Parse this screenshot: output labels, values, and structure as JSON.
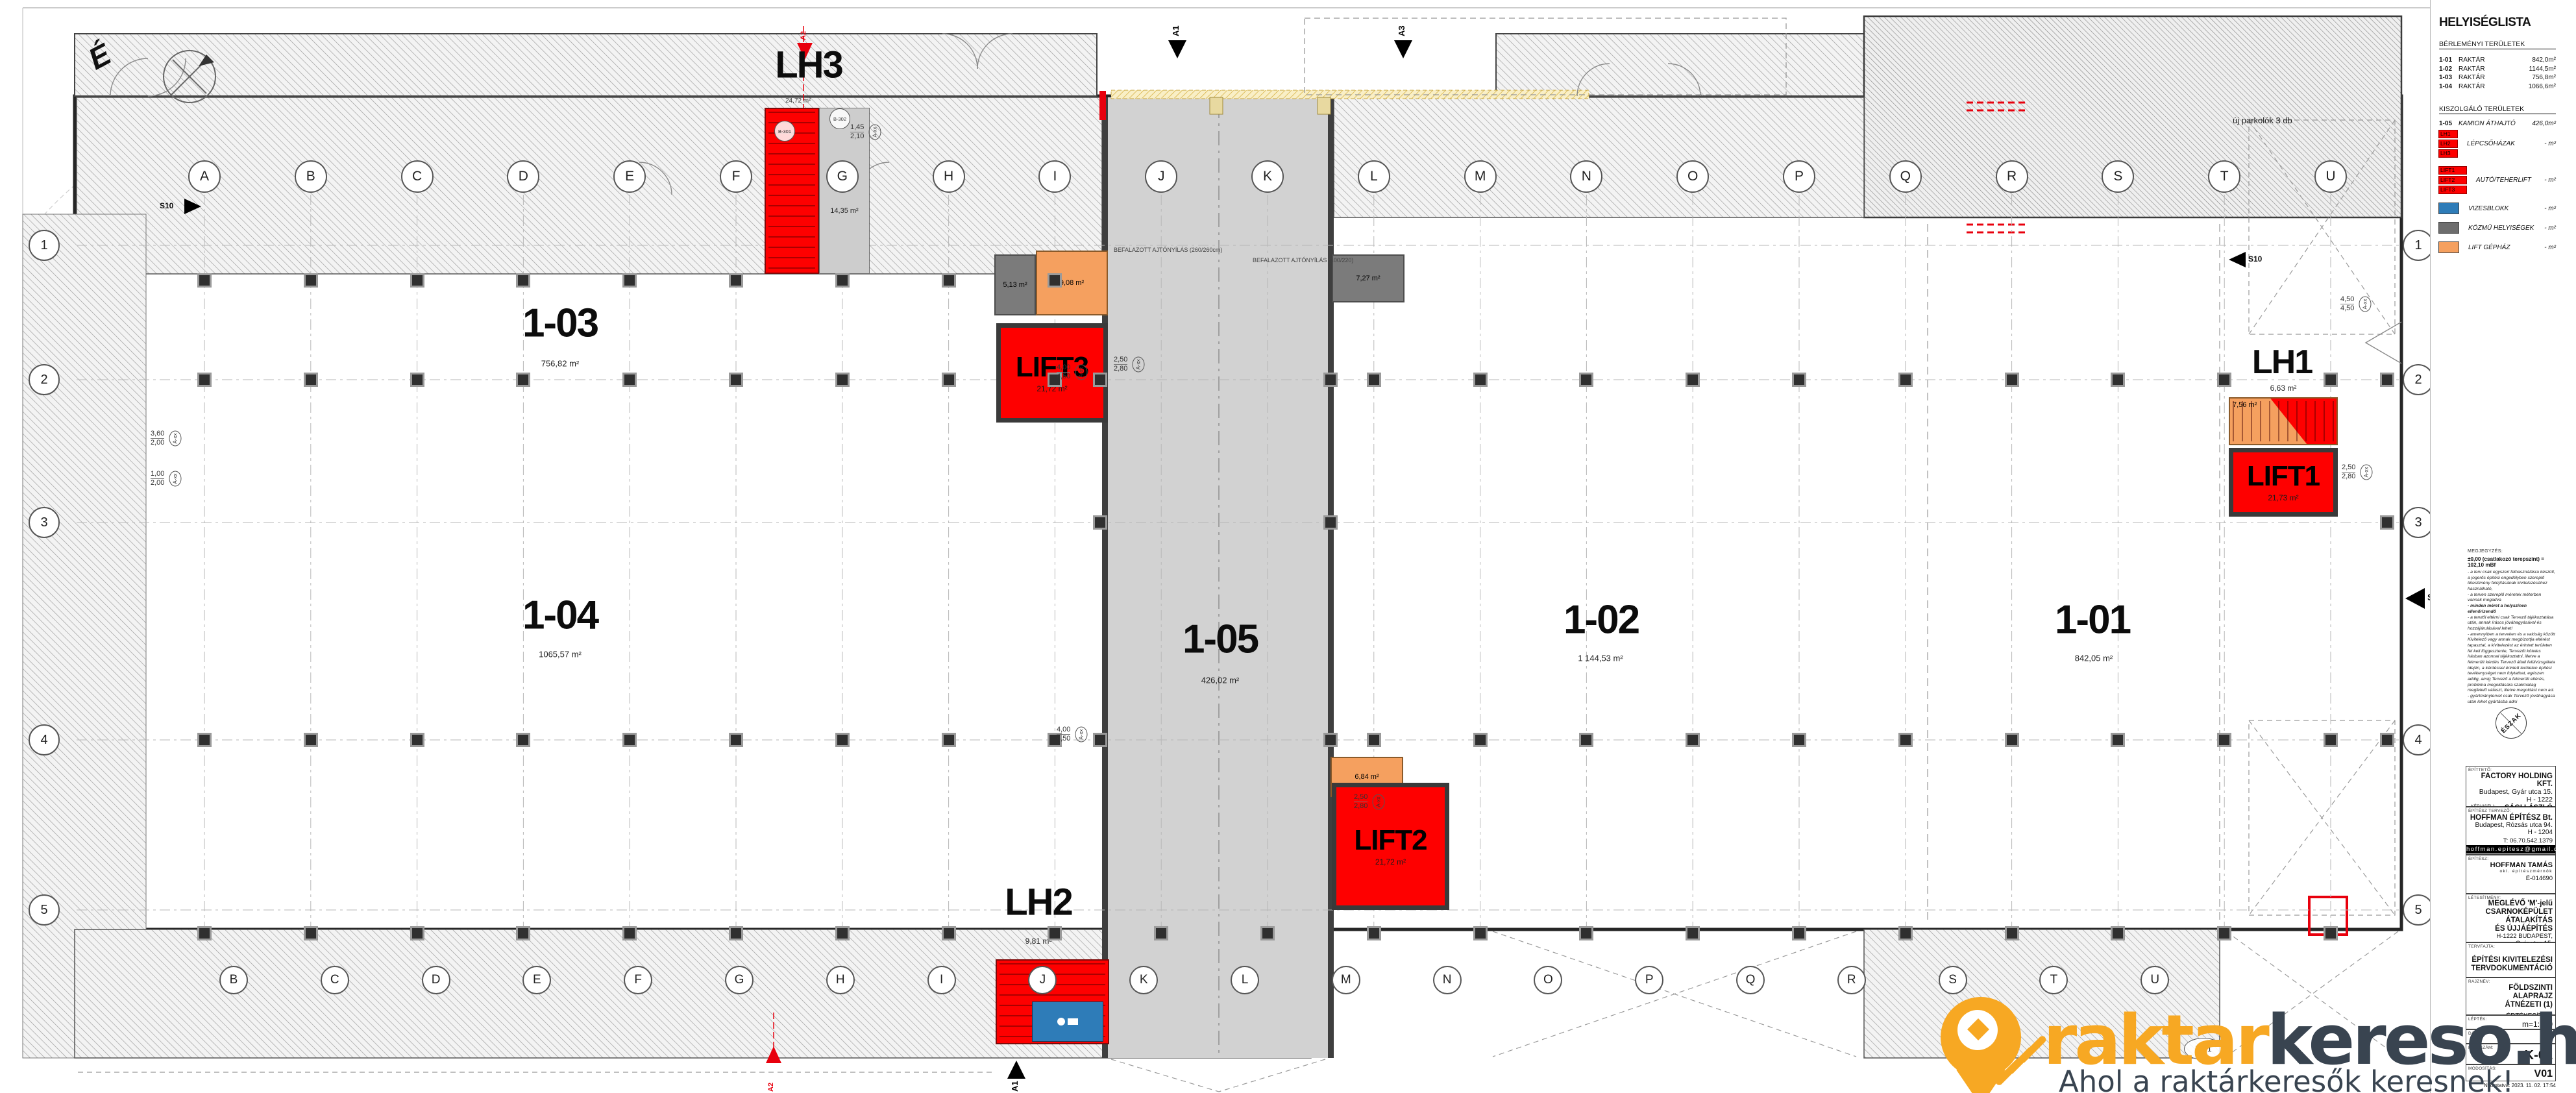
{
  "legend": {
    "title": "HELYISÉGLISTA",
    "rental_heading": "BÉRLEMÉNYI TERÜLETEK",
    "rental_rows": [
      {
        "id": "1-01",
        "name": "RAKTÁR",
        "area": "842,0m²"
      },
      {
        "id": "1-02",
        "name": "RAKTÁR",
        "area": "1144,5m²"
      },
      {
        "id": "1-03",
        "name": "RAKTÁR",
        "area": "756,8m²"
      },
      {
        "id": "1-04",
        "name": "RAKTÁR",
        "area": "1066,6m²"
      }
    ],
    "service_heading": "KISZOLGÁLÓ TERÜLETEK",
    "service_rows": [
      {
        "id": "1-05",
        "name": "KAMION ÁTHAJTÓ",
        "area": "426,0m²"
      }
    ],
    "tag_rows": [
      {
        "tags": [
          "LH1",
          "LH2",
          "LH3"
        ],
        "label": "LÉPCSŐHÁZAK",
        "area": "- m²"
      },
      {
        "tags": [
          "LIFT1",
          "LIFT2",
          "LIFT3"
        ],
        "label": "AUTÓ/TEHERLIFT",
        "area": "- m²"
      }
    ],
    "swatch_rows": [
      {
        "color": "#2e7cb8",
        "label": "VIZESBLOKK",
        "area": "- m²"
      },
      {
        "color": "#6d6d6d",
        "label": "KÖZMŰ HELYISÉGEK",
        "area": "- m²"
      },
      {
        "color": "#f5a05f",
        "label": "LIFT GÉPHÁZ",
        "area": "- m²"
      }
    ],
    "tag_color": "#fe0000"
  },
  "notes": {
    "heading": "MEGJEGYZÉS:",
    "datum_line": "±0,00 (csatlakozó terepszint) = 102,10 mBf",
    "lines": [
      {
        "t": "- a terv csak egyszeri felhasználásra készült, a jogerős építési engedélyben szereplő létesítmény felújításának kivitelezéséhez használható,",
        "b": false
      },
      {
        "t": "- a terven szereplő méretek méterben vannak megadva",
        "b": false
      },
      {
        "t": "- minden méret a helyszínen ellenőrizendő",
        "b": true
      },
      {
        "t": "- a tervtől eltérni csak Tervező tájékoztatása után, annak írásos jóváhagyásával és hozzájárulásával lehet!",
        "b": false
      },
      {
        "t": "- amennyiben a terveken és a valóság között Kivitelező vagy annak megbízottja eltérést tapasztal, a kivitelezést az érintett területen fel kell függesztenie, Tervezőt köteles írásban azonnal tájékoztatni, illetve a felmerült kérdés Tervező általi felülvizsgálata idején, a kérdéssel érintett területen építési tevékenységet nem folytathat, egészen addig, amíg Tervező a felmerült eltérés, probléma megoldására szakmailag megfelelő választ, illetve megoldást nem ad.",
        "b": false
      },
      {
        "t": "- gyártmánytervet csak Tervező jóváhagyása után lehet gyártásba adni",
        "b": false
      }
    ],
    "compass_label": "ÉSZAK"
  },
  "titleblock": {
    "client_label": "ÉPÍTTETŐ:",
    "client_name": "FACTORY HOLDING KFT.",
    "client_addr1": "Budapest, Gyár utca 15.",
    "client_addr2": "H - 1222",
    "rep_label": "KÉPVISELI:",
    "rep_name": "SÁGI LÁSZLÓ",
    "designer_label": "ÉPÍTÉSZ TERVEZŐ:",
    "designer_name": "HOFFMAN ÉPÍTÉSZ Bt.",
    "designer_addr1": "Budapest, Rózsás utca 94.",
    "designer_addr2": "H - 1204",
    "designer_phone": "T: 06.70.542.1379",
    "designer_email": "hoffman.epitesz@gmail.com",
    "architect_label": "ÉPÍTÉSZ:",
    "architect_name": "HOFFMAN TAMÁS",
    "architect_title": "okl. építészmérnök",
    "architect_reg": "É-014690",
    "facility_label": "LÉTESÍTMÉNY:",
    "facility_line1": "MEGLÉVŐ 'M'-jelű",
    "facility_line2": "CSARNOKÉPÜLET ÁTALAKÍTÁS",
    "facility_line3": "ÉS ÚJJÁÉPÍTÉS",
    "facility_addr1": "H-1222 BUDAPEST,",
    "facility_addr2": "Gyár utca 15.",
    "facility_addr3": "hrsz.:22497/5",
    "plantype_label": "TERVFAJTA:",
    "plantype_line1": "ÉPÍTÉSI KIVITELEZÉSI",
    "plantype_line2": "TERVDOKUMENTÁCIÓ",
    "drawing_label": "RAJZNÉV:",
    "drawing_line1": "FÖLDSZINTI ALAPRAJZ",
    "drawing_line2": "ÁTNÉZETI (1)",
    "drawing_tag": "ÉRTÉKESÍTÉSI",
    "scale_label": "LÉPTÉK:",
    "scale_value": "m=1:100",
    "date_label": "DÁTUM:",
    "date_value": "30",
    "number_label": "RAJZSZÁM:",
    "number_value": "K-01",
    "revision_label": "MÓDOSÍTÁS:",
    "revision_value": "V01",
    "printed": "Nyomtatva: 2023. 11. 02. 17:54"
  },
  "plan": {
    "north_label": "É",
    "rooms": [
      {
        "id": "1-03",
        "area": "756,82 m²"
      },
      {
        "id": "1-04",
        "area": "1065,57 m²"
      },
      {
        "id": "1-05",
        "area": "426,02 m²"
      },
      {
        "id": "1-02",
        "area": "1 144,53 m²"
      },
      {
        "id": "1-01",
        "area": "842,05 m²"
      }
    ],
    "stairs": [
      {
        "id": "LH1",
        "area": "6,63 m²"
      },
      {
        "id": "LH2",
        "area": "9,81 m²"
      },
      {
        "id": "LH3",
        "area": "24,72 m²"
      }
    ],
    "lifts": [
      {
        "id": "LIFT1",
        "area": "21,73 m²"
      },
      {
        "id": "LIFT2",
        "area": "21,72 m²"
      },
      {
        "id": "LIFT3",
        "area": "21,72 m²"
      }
    ],
    "small_rooms": {
      "gray1": "5,13 m²",
      "orange1": "9,08 m²",
      "lgray1": "14,35 m²",
      "gray2": "7,27 m²",
      "orange2": "6,84 m²",
      "orange3": "7,56 m²"
    },
    "annotations": {
      "parking": "új parkolók 3 db",
      "walled_door1": "BEFALAZOTT AJTÓNYÍLÁS (260/260cm)",
      "walled_door2": "BEFALAZOTT AJTÓNYÍLÁS (100/220)",
      "tag_b301": "B-301",
      "tag_b302": "B-302",
      "tag_u21": "Ü2/1",
      "tag_axx": "A-xx"
    },
    "markers": {
      "a1": "A1",
      "a2": "A2",
      "a3": "A3",
      "s1": "S1",
      "s10": "S10"
    },
    "grid": {
      "top_letters": [
        "A",
        "B",
        "C",
        "D",
        "E",
        "F",
        "G",
        "H",
        "I",
        "J",
        "K",
        "L",
        "M",
        "N",
        "O",
        "P",
        "Q",
        "R",
        "S",
        "T",
        "U"
      ],
      "bottom_letters": [
        "B",
        "C",
        "D",
        "E",
        "F",
        "G",
        "H",
        "I",
        "J",
        "K",
        "L",
        "M",
        "N",
        "O",
        "P",
        "Q",
        "R",
        "S",
        "T",
        "U"
      ],
      "numbers": [
        "1",
        "2",
        "3",
        "4",
        "5"
      ]
    },
    "dims": [
      {
        "a": "4,00",
        "b": "4,50"
      },
      {
        "a": "4,00",
        "b": "4,50"
      },
      {
        "a": "2,50",
        "b": "2,80"
      },
      {
        "a": "2,50",
        "b": "2,80"
      },
      {
        "a": "3,60",
        "b": "2,00"
      },
      {
        "a": "1,00",
        "b": "2,00"
      },
      {
        "a": "1,45",
        "b": "2,10"
      },
      {
        "a": "2,50",
        "b": "2,80"
      },
      {
        "a": "4,50",
        "b": "4,50"
      }
    ]
  },
  "logo": {
    "word1": "raktar",
    "word2": "kereso",
    "tld": ".hu",
    "tagline": "Ahol a raktárkeresők keresnek!",
    "orange": "#f7a823",
    "navy": "#394450"
  }
}
